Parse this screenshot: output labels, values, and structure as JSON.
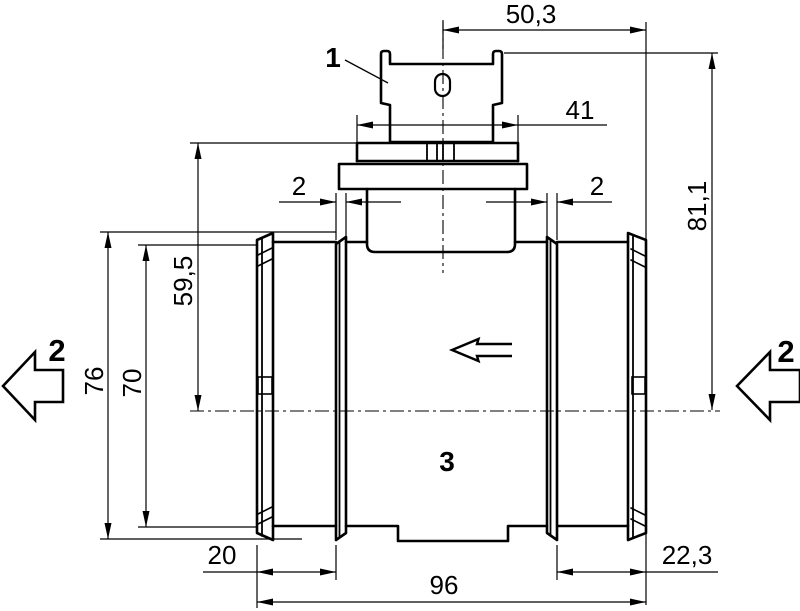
{
  "drawing": {
    "background_color": "#ffffff",
    "line_color": "#000000",
    "dimensions": {
      "top_width": "50,3",
      "connector_flange_width": "41",
      "seal_ring_left": "2",
      "seal_ring_right": "2",
      "total_height": "81,1",
      "flange_to_axis_height": "59,5",
      "outer_diameter": "76",
      "tube_diameter": "70",
      "left_offset": "20",
      "tube_length": "96",
      "right_offset": "22,3"
    },
    "part_labels": {
      "connector": "1",
      "flow_direction_left": "2",
      "flow_direction_right": "2",
      "housing": "3"
    }
  }
}
